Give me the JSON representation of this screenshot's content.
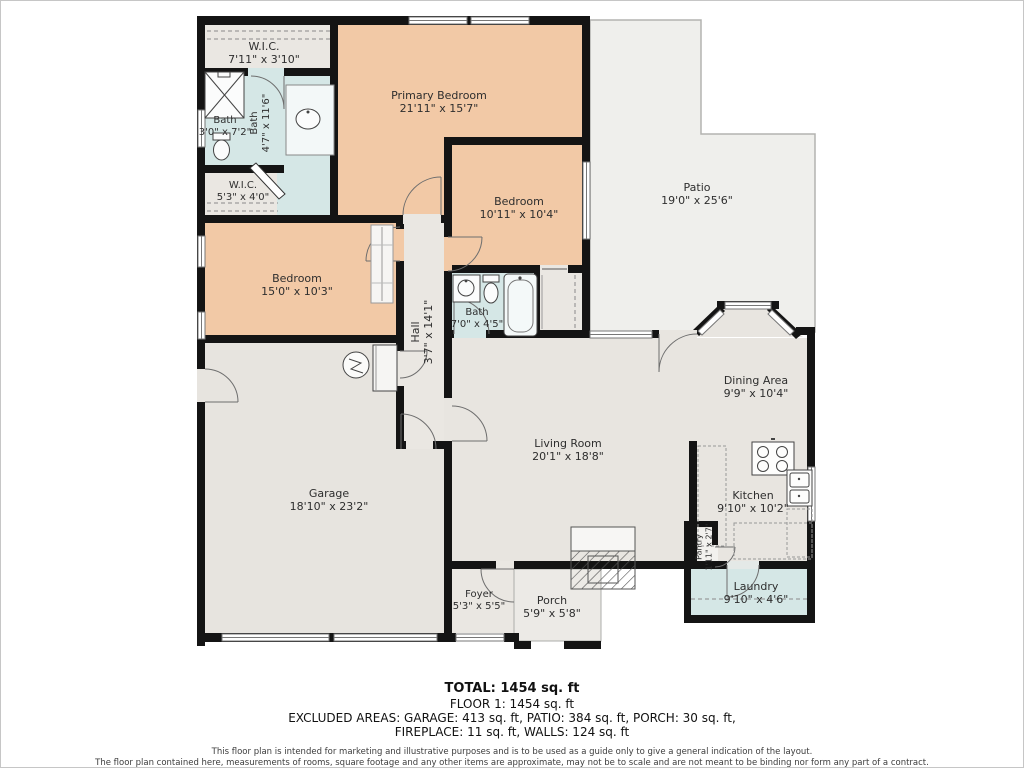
{
  "rooms": [
    {
      "name": "W.I.C.",
      "dims": "7'11\" x 3'10\""
    },
    {
      "name": "Primary Bedroom",
      "dims": "21'11\" x 15'7\""
    },
    {
      "name": "Bath",
      "dims": "3'0\" x 7'2\""
    },
    {
      "name": "Bath",
      "dims": "4'7\" x 11'6\""
    },
    {
      "name": "W.I.C.",
      "dims": "5'3\" x 4'0\""
    },
    {
      "name": "Bedroom",
      "dims": "10'11\" x 10'4\""
    },
    {
      "name": "Patio",
      "dims": "19'0\" x 25'6\""
    },
    {
      "name": "Bedroom",
      "dims": "15'0\" x 10'3\""
    },
    {
      "name": "Hall",
      "dims": "3'7\" x 14'1\""
    },
    {
      "name": "Bath",
      "dims": "7'0\" x 4'5\""
    },
    {
      "name": "Living Room",
      "dims": "20'1\" x 18'8\""
    },
    {
      "name": "Dining Area",
      "dims": "9'9\" x 10'4\""
    },
    {
      "name": "Garage",
      "dims": "18'10\" x 23'2\""
    },
    {
      "name": "Kitchen",
      "dims": "9'10\" x 10'2\""
    },
    {
      "name": "Pantry",
      "dims": "1'11\" x 2'7\""
    },
    {
      "name": "Laundry",
      "dims": "9'10\" x 4'6\""
    },
    {
      "name": "Foyer",
      "dims": "5'3\" x 5'5\""
    },
    {
      "name": "Porch",
      "dims": "5'9\" x 5'8\""
    }
  ],
  "summary": {
    "total": "TOTAL: 1454 sq. ft",
    "floor": "FLOOR 1: 1454 sq. ft",
    "excluded_1": "EXCLUDED AREAS: GARAGE: 413 sq. ft, PATIO: 384 sq. ft, PORCH: 30 sq. ft,",
    "excluded_2": "FIREPLACE: 11 sq. ft, WALLS: 124 sq. ft"
  },
  "disclaimer": {
    "line_1": "This floor plan is intended for marketing and illustrative purposes and is to be used as a guide only to give a general indication of the layout.",
    "line_2": "The floor plan contained here, measurements of rooms, square footage and any other items are approximate, may not be to scale and are not meant to be binding nor form any part of a contract.",
    "line_3": "No responsibility is taken for any error, omission, or misstatement. Prospective purchasers are encouraged to conduct their own due diligence."
  },
  "colors": {
    "bedroom_fill": "#f2c9a6",
    "bath_fill": "#d5e7e6",
    "floor_fill": "#eae7e2",
    "patio_fill": "#efefec",
    "wall": "#141414"
  }
}
